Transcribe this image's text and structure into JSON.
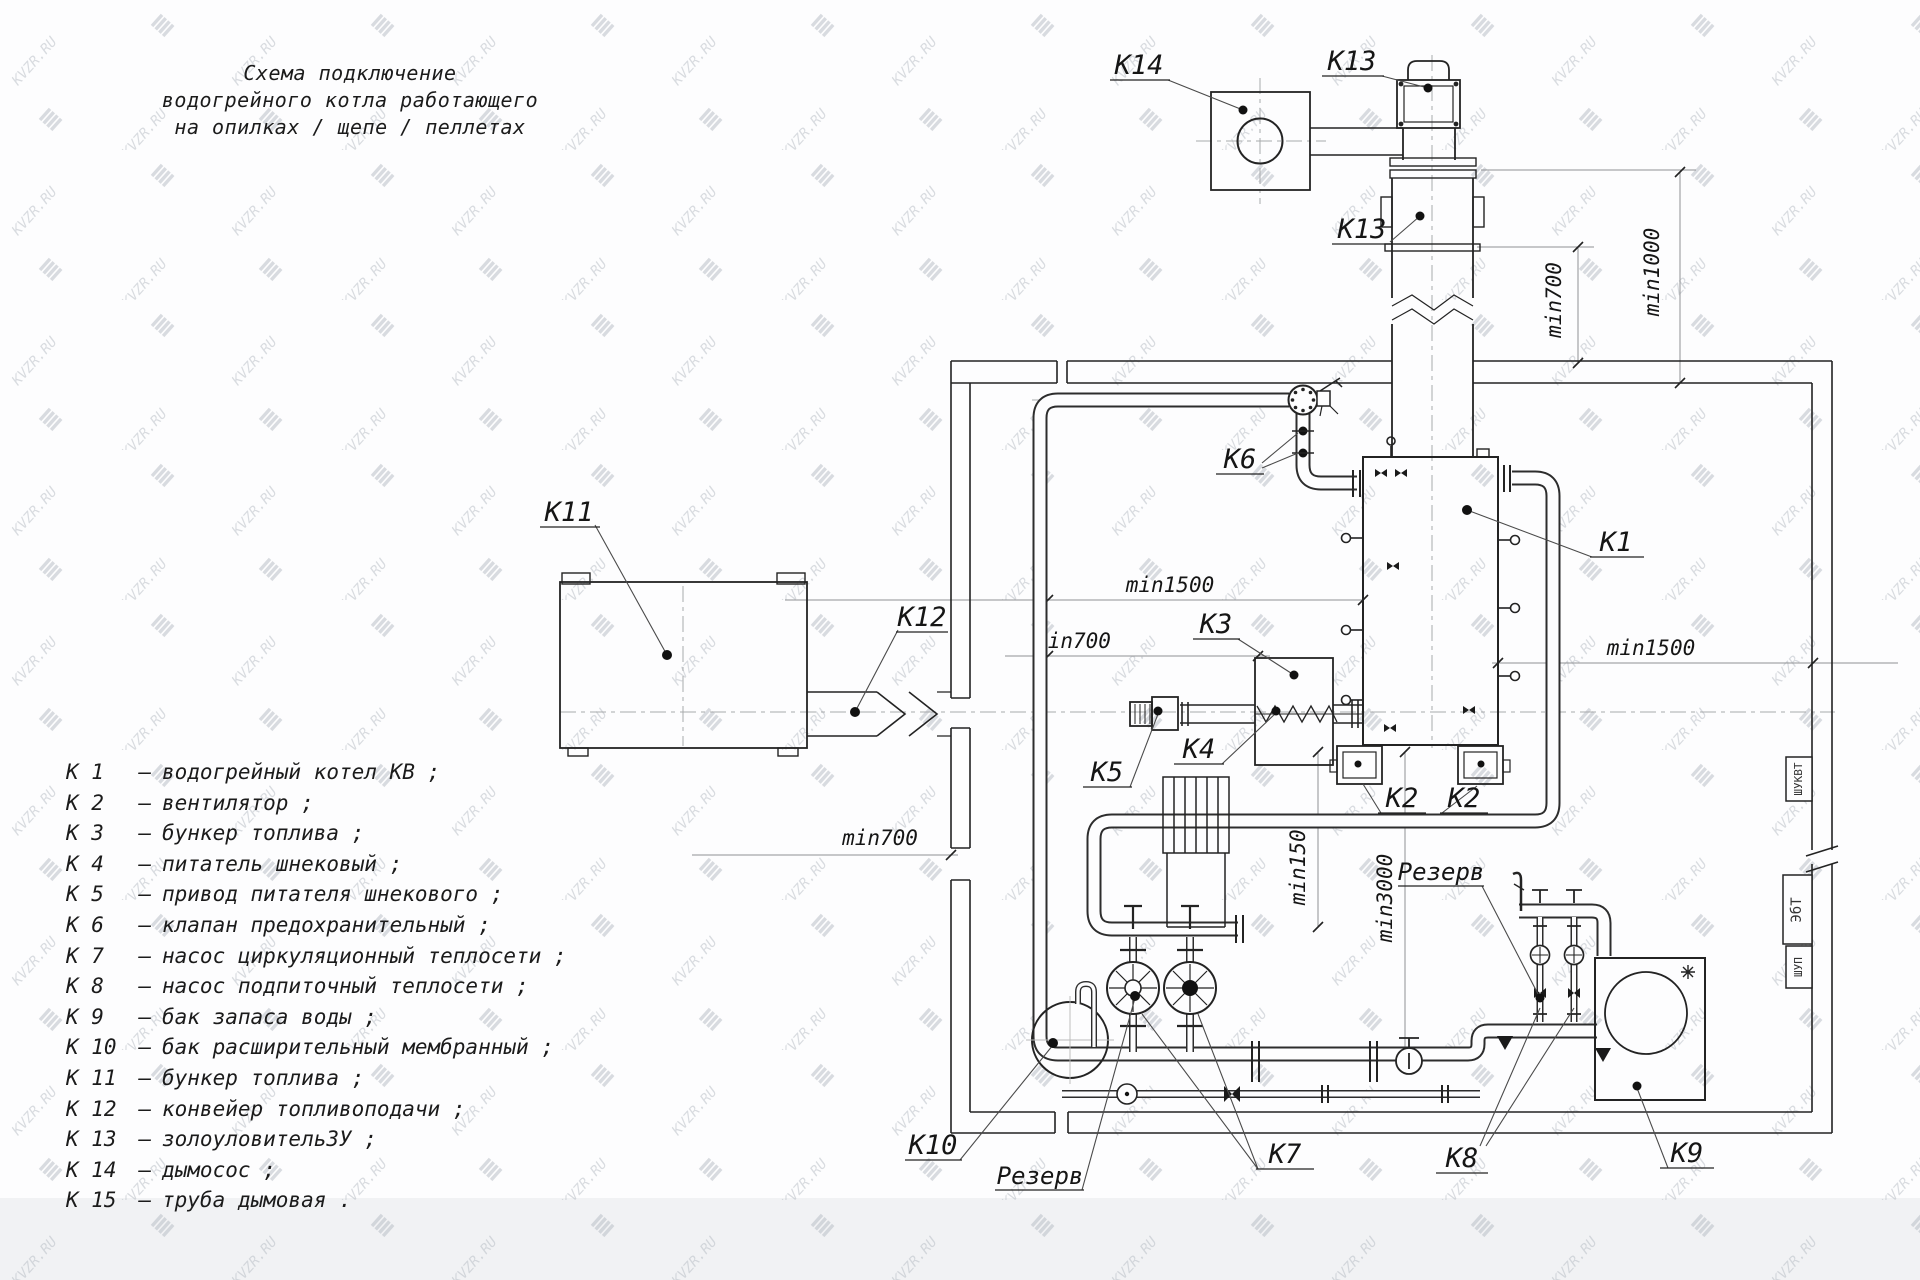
{
  "title": {
    "line1": "Схема подключение",
    "line2": "водогрейного котла работающего",
    "line3": "на опилках / щепе / пеллетах"
  },
  "legend": {
    "separator": "–",
    "items": [
      {
        "num": "К 1",
        "desc": "водогрейный котел КВ ;"
      },
      {
        "num": "К 2",
        "desc": "вентилятор ;"
      },
      {
        "num": "К 3",
        "desc": "бункер топлива ;"
      },
      {
        "num": "К 4",
        "desc": "питатель шнековый ;"
      },
      {
        "num": "К 5",
        "desc": "привод питателя шнекового ;"
      },
      {
        "num": "К 6",
        "desc": "клапан предохранительный ;"
      },
      {
        "num": "К 7",
        "desc": "насос циркуляционный теплосети ;"
      },
      {
        "num": "К 8",
        "desc": "насос подпиточный теплосети ;"
      },
      {
        "num": "К 9",
        "desc": "бак запаса воды ;"
      },
      {
        "num": "К 10",
        "desc": "бак расширительный мембранный ;"
      },
      {
        "num": "К 11",
        "desc": "бункер топлива ;"
      },
      {
        "num": "К 12",
        "desc": "конвейер топливоподачи ;"
      },
      {
        "num": "К 13",
        "desc": "золоуловительЗУ ;"
      },
      {
        "num": "К 14",
        "desc": "дымосос ;"
      },
      {
        "num": "К 15",
        "desc": "труба дымовая ."
      }
    ]
  },
  "diagram": {
    "callouts": {
      "k14": "К14",
      "k13_top": "К13",
      "k13_mid": "К13",
      "k11": "К11",
      "k12": "К12",
      "k1": "К1",
      "k6": "К6",
      "k3": "К3",
      "k4": "К4",
      "k5": "К5",
      "k2_left": "К2",
      "k2_right": "К2",
      "k10": "К10",
      "k7": "К7",
      "k8": "К8",
      "k9": "К9",
      "reserve_left": "Резерв",
      "reserve_right": "Резерв"
    },
    "dimensions": {
      "top_700": "min700",
      "top_1000": "min1000",
      "left_1500": "min1500",
      "mid_700": "min700",
      "low_700": "min700",
      "vert_1500": "min1500",
      "vert_3000": "min3000",
      "right_1500": "min1500"
    },
    "panels": {
      "p1": "ШУКВТ",
      "p2": "ЭбТ",
      "p3": "ШУП"
    }
  },
  "watermark": {
    "text": "KVZR.RU"
  }
}
